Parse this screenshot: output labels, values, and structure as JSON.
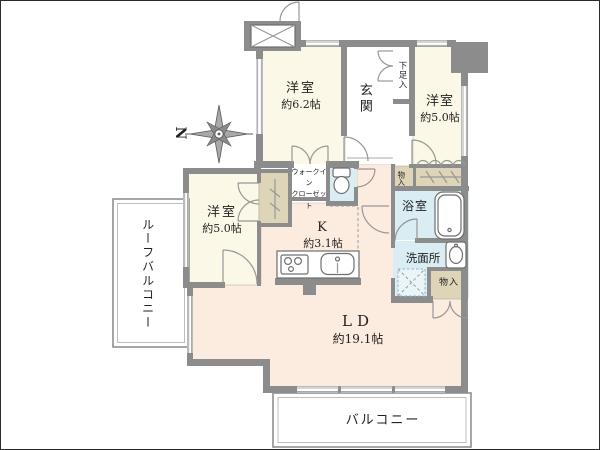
{
  "palette": {
    "wall": "#8c8c8c",
    "room_cream": "#fbf8e7",
    "room_peach": "#fcebdf",
    "wet_area_blue": "#d9edf2",
    "closet_beige": "#ded5b9",
    "line": "#979797",
    "text": "#222222"
  },
  "compass": {
    "label": "N"
  },
  "rooms": {
    "bedroom_top_left": {
      "name": "洋室",
      "size": "約6.2帖"
    },
    "bedroom_top_right": {
      "name": "洋室",
      "size": "約5.0帖"
    },
    "bedroom_left": {
      "name": "洋室",
      "size": "約5.0帖"
    },
    "kitchen": {
      "name": "K",
      "size": "約3.1帖"
    },
    "living_dining": {
      "name": "LD",
      "size": "約19.1帖"
    },
    "entrance": {
      "name": "玄関"
    },
    "shoe_storage": {
      "name": "下足入"
    },
    "walk_in_closet": {
      "line1": "ウォークイン",
      "line2": "クローゼット"
    },
    "bathroom": {
      "name": "浴室"
    },
    "washroom": {
      "name": "洗面所"
    },
    "storage_upper": {
      "name": "物入"
    },
    "storage_lower": {
      "name": "物入"
    },
    "roof_balcony": {
      "name": "ルーフバルコニー"
    },
    "balcony": {
      "name": "バルコニー"
    }
  }
}
